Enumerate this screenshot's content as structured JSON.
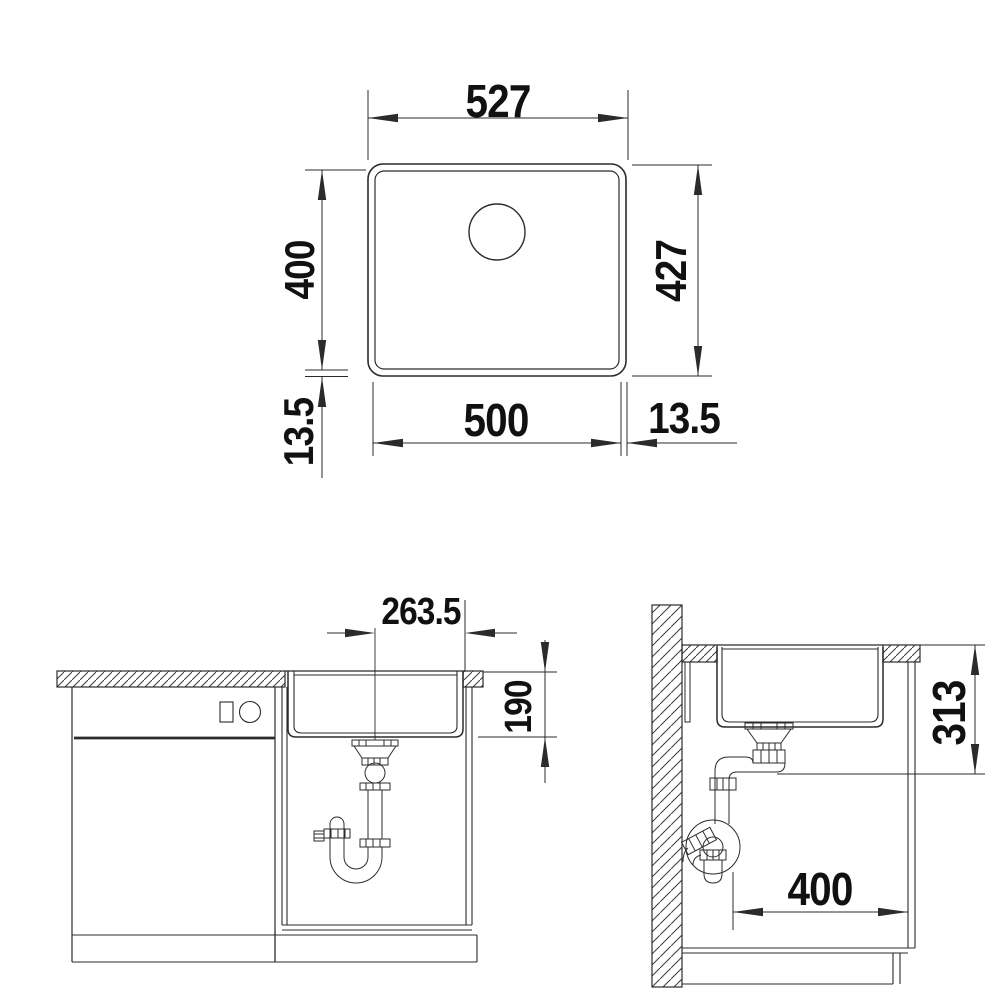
{
  "page": {
    "background": "#ffffff",
    "line_color": "#2b2b2b",
    "text_color": "#111111",
    "description": "Technical installation drawing of an undermount kitchen sink: plan view (top), front section (bottom left), side section (bottom right)"
  },
  "labels": {
    "plan": {
      "outer_width": "527",
      "inner_height": "400",
      "outer_height": "427",
      "inner_width": "500",
      "rim_left": "13.5",
      "rim_right": "13.5"
    },
    "front": {
      "drain_center_to_edge": "263.5",
      "bowl_depth": "190"
    },
    "side": {
      "top_to_drain_outlet": "313",
      "drain_to_front": "400"
    }
  }
}
